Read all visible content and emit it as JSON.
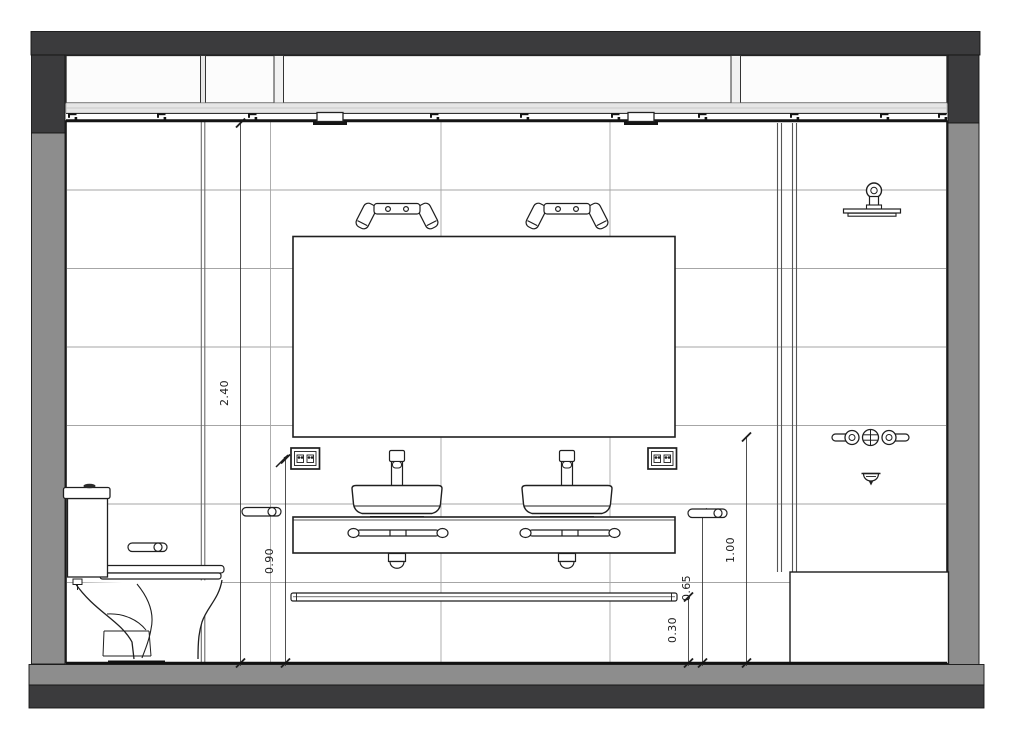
{
  "document": {
    "kind": "bathroom-interior-elevation-section"
  },
  "dimensions": {
    "wall_height": {
      "label": "2.40"
    },
    "outlet_height": {
      "label": "0.90"
    },
    "mirror_bottom_height": {
      "label": "1.00"
    },
    "towel_rail_height": {
      "label": "0.65"
    },
    "shelf_height": {
      "label": "0.30"
    }
  },
  "fixtures": [
    "transom-windows",
    "curtain-track",
    "track-clip",
    "track-bracket",
    "toilet",
    "toilet-paper-holder",
    "towel-holder-left",
    "towel-holder-right",
    "wall-mirror",
    "sconce-left",
    "sconce-right",
    "outlet-left",
    "outlet-right",
    "vessel-sink-left",
    "vessel-sink-right",
    "faucet-left",
    "faucet-right",
    "vanity-counter",
    "counter-towel-bar-left",
    "counter-towel-bar-right",
    "drain-trap-left",
    "drain-trap-right",
    "low-shelf-rail",
    "shower-head",
    "shower-valves",
    "tub-spout",
    "bathtub",
    "shower-partition"
  ],
  "colors": {
    "section_dark": "#3b3b3d",
    "section_gray": "#8d8d8d",
    "sill_gray": "#e6e6e6",
    "line_black": "#1c1c1c",
    "grid_gray": "#a6a6a6",
    "background": "#ffffff"
  }
}
